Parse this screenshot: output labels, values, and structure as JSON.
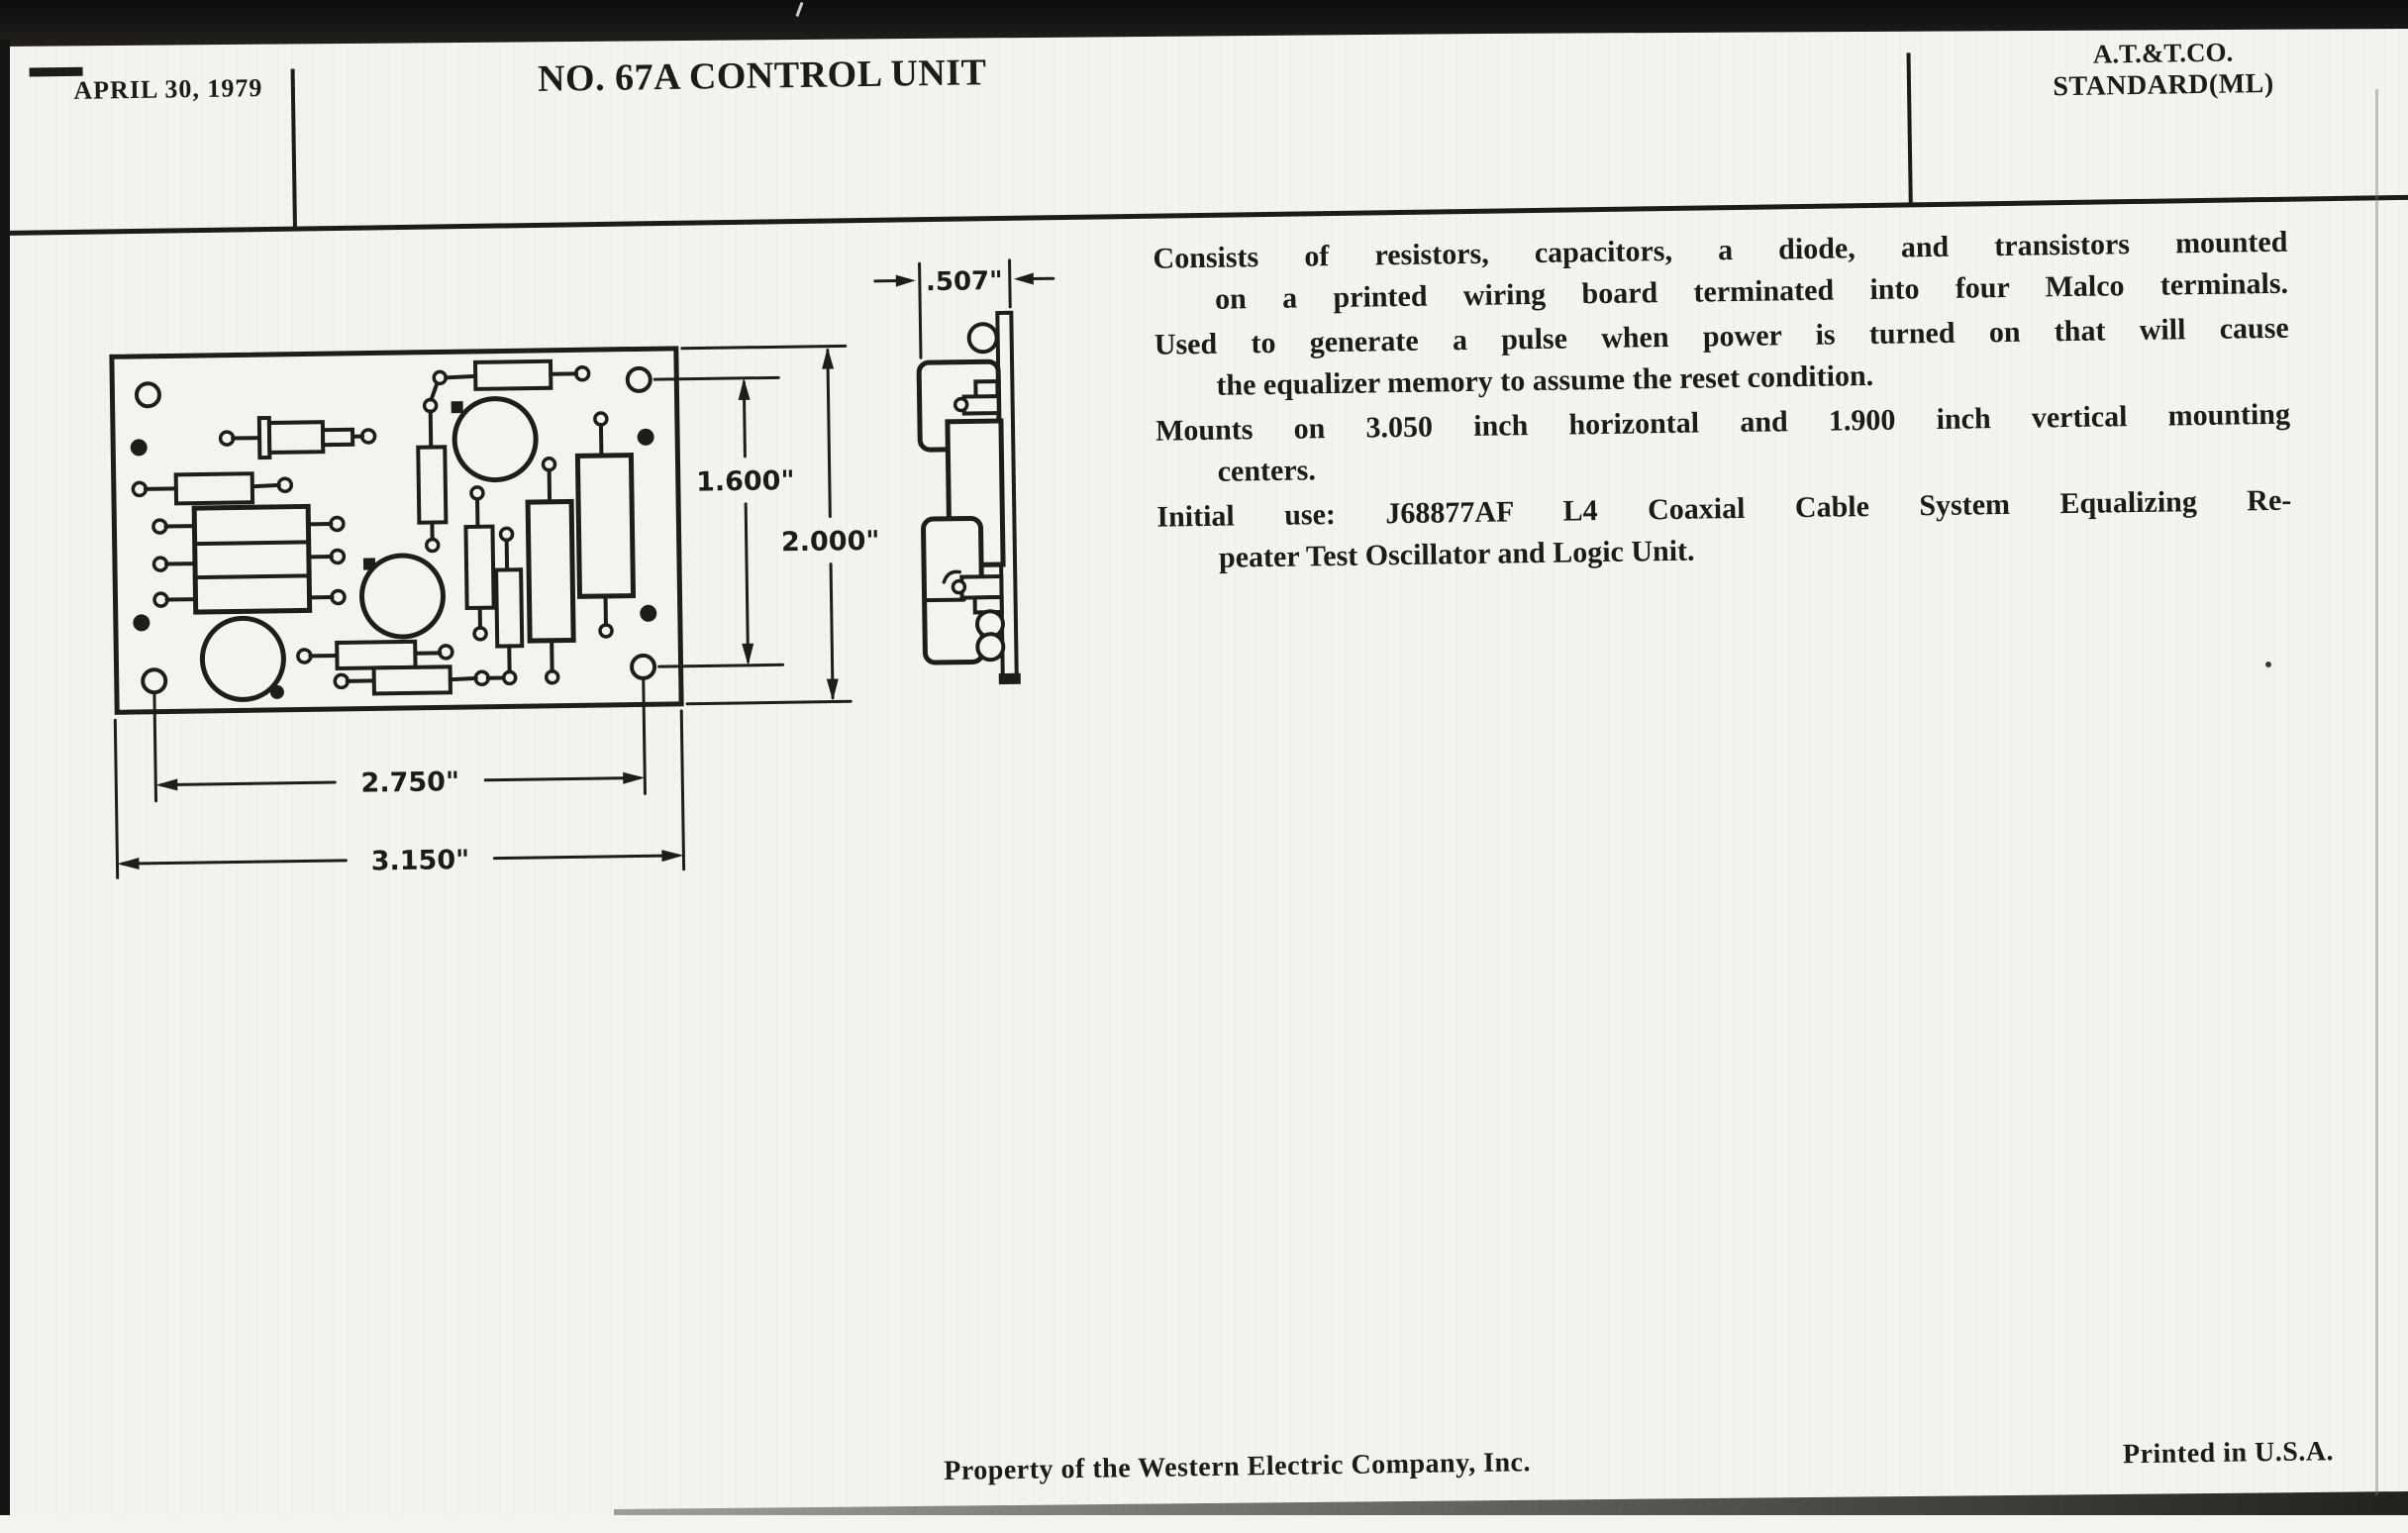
{
  "header": {
    "date": "APRIL 30, 1979",
    "title": "NO. 67A CONTROL UNIT",
    "org_line1": "A.T.&T.CO.",
    "org_line2": "STANDARD(ML)"
  },
  "drawing": {
    "dim_inner_height": "1.600\"",
    "dim_full_height": "2.000\"",
    "dim_hole_span": "2.750\"",
    "dim_full_width": "3.150\"",
    "dim_side_depth": ".507\""
  },
  "description": {
    "paragraphs": [
      {
        "lines": [
          "Consists of resistors, capacitors, a diode, and transistors mounted",
          "on a printed wiring board terminated into four Malco terminals."
        ]
      },
      {
        "lines": [
          "Used to generate a pulse when power is turned on that will cause",
          "the equalizer memory to assume the reset condition."
        ]
      },
      {
        "lines": [
          "Mounts on 3.050 inch horizontal and 1.900 inch vertical mounting",
          "centers."
        ]
      },
      {
        "lines": [
          "Initial use: J68877AF L4 Coaxial Cable System Equalizing Re-",
          "peater Test Oscillator and Logic Unit."
        ]
      }
    ]
  },
  "footer": {
    "property": "Property of the Western Electric Company, Inc.",
    "printed": "Printed in U.S.A."
  }
}
